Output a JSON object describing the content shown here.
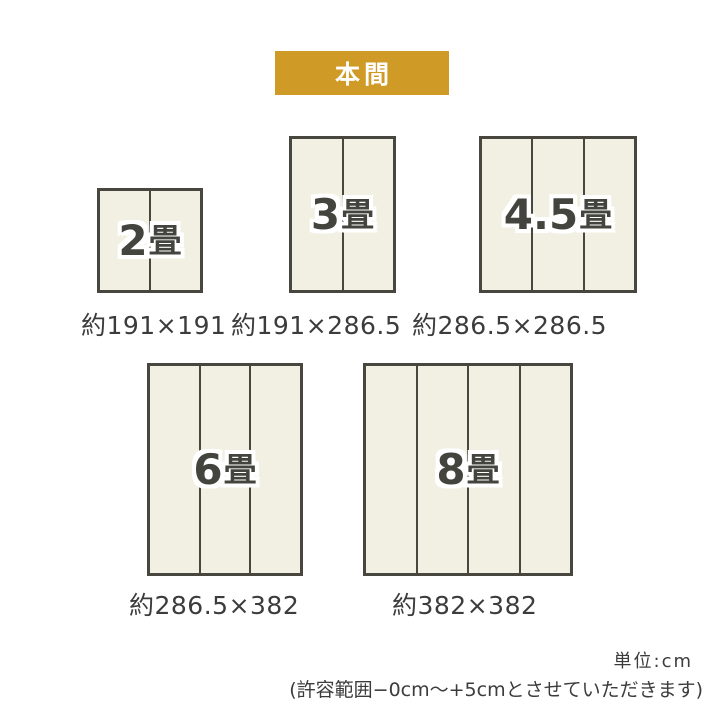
{
  "header": {
    "standard_label": "本間"
  },
  "colors": {
    "accent_gold": "#cf9a26",
    "mat_fill": "#f2f0e2",
    "mat_border": "#474740",
    "text_dark": "#3c3c3c"
  },
  "mats": [
    {
      "size_value": "2",
      "size_unit": "畳",
      "dimensions": "約191×191",
      "panels": 2
    },
    {
      "size_value": "3",
      "size_unit": "畳",
      "dimensions": "約191×286.5",
      "panels": 2
    },
    {
      "size_value": "4.5",
      "size_unit": "畳",
      "dimensions": "約286.5×286.5",
      "panels": 3
    },
    {
      "size_value": "6",
      "size_unit": "畳",
      "dimensions": "約286.5×382",
      "panels": 3
    },
    {
      "size_value": "8",
      "size_unit": "畳",
      "dimensions": "約382×382",
      "panels": 4
    }
  ],
  "footer": {
    "unit_label": "単位:cm",
    "tolerance_note": "(許容範囲−0cm〜+5cmとさせていただきます)"
  }
}
